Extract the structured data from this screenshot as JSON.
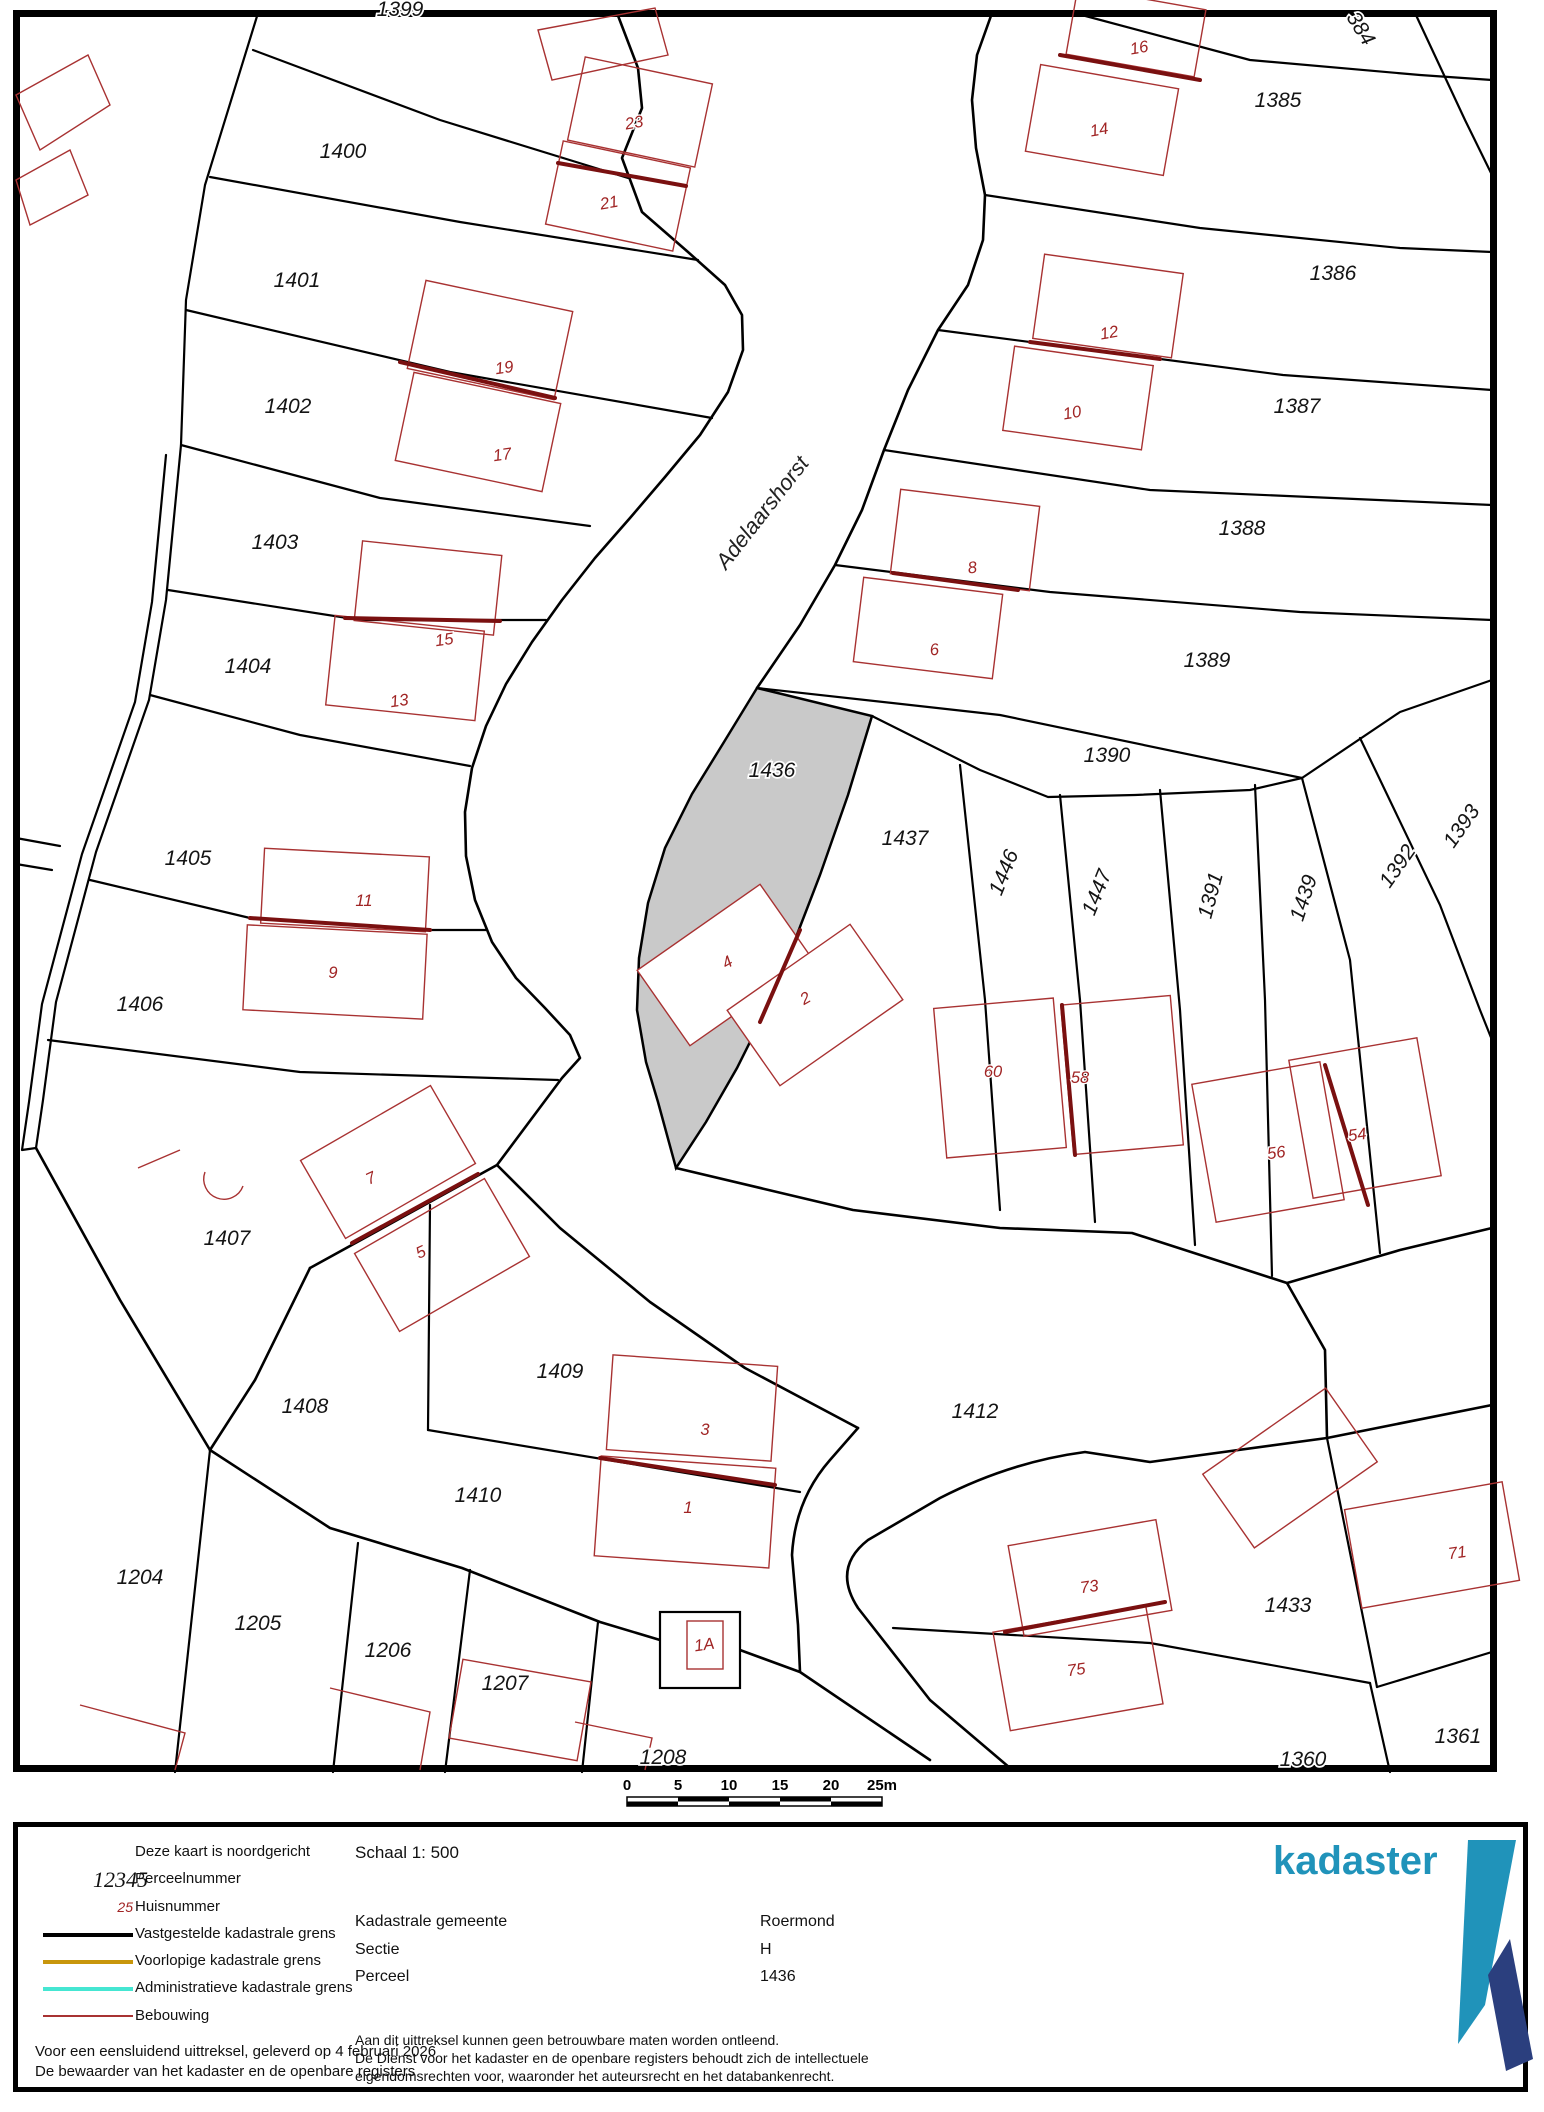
{
  "map": {
    "street_name": "Adelaarshorst",
    "highlight_parcel_fill": "#c9c9c9",
    "building_color": "#a83232",
    "scale_ticks": [
      "0",
      "5",
      "10",
      "15",
      "20",
      "25m"
    ],
    "labels": [
      {
        "text": "1399",
        "x": 400,
        "y": 16,
        "rot": 0,
        "type": "parcel"
      },
      {
        "text": "1400",
        "x": 343,
        "y": 158,
        "rot": 0,
        "type": "parcel"
      },
      {
        "text": "1401",
        "x": 297,
        "y": 287,
        "rot": 0,
        "type": "parcel"
      },
      {
        "text": "1402",
        "x": 288,
        "y": 413,
        "rot": 0,
        "type": "parcel"
      },
      {
        "text": "1403",
        "x": 275,
        "y": 549,
        "rot": 0,
        "type": "parcel"
      },
      {
        "text": "1404",
        "x": 248,
        "y": 673,
        "rot": 0,
        "type": "parcel"
      },
      {
        "text": "1405",
        "x": 188,
        "y": 865,
        "rot": 0,
        "type": "parcel"
      },
      {
        "text": "1406",
        "x": 140,
        "y": 1011,
        "rot": 0,
        "type": "parcel"
      },
      {
        "text": "1407",
        "x": 227,
        "y": 1245,
        "rot": 0,
        "type": "parcel"
      },
      {
        "text": "1408",
        "x": 305,
        "y": 1413,
        "rot": 0,
        "type": "parcel"
      },
      {
        "text": "1409",
        "x": 560,
        "y": 1378,
        "rot": 0,
        "type": "parcel"
      },
      {
        "text": "1410",
        "x": 478,
        "y": 1502,
        "rot": 0,
        "type": "parcel"
      },
      {
        "text": "1412",
        "x": 975,
        "y": 1418,
        "rot": 0,
        "type": "parcel"
      },
      {
        "text": "1204",
        "x": 140,
        "y": 1584,
        "rot": 0,
        "type": "parcel"
      },
      {
        "text": "1205",
        "x": 258,
        "y": 1630,
        "rot": 0,
        "type": "parcel"
      },
      {
        "text": "1206",
        "x": 388,
        "y": 1657,
        "rot": 0,
        "type": "parcel"
      },
      {
        "text": "1207",
        "x": 505,
        "y": 1690,
        "rot": 0,
        "type": "parcel"
      },
      {
        "text": "1208",
        "x": 663,
        "y": 1764,
        "rot": 0,
        "type": "parcel"
      },
      {
        "text": "384",
        "x": 1355,
        "y": 32,
        "rot": 58,
        "type": "parcel"
      },
      {
        "text": "1385",
        "x": 1278,
        "y": 107,
        "rot": 0,
        "type": "parcel"
      },
      {
        "text": "1386",
        "x": 1333,
        "y": 280,
        "rot": 0,
        "type": "parcel"
      },
      {
        "text": "1387",
        "x": 1297,
        "y": 413,
        "rot": 0,
        "type": "parcel"
      },
      {
        "text": "1388",
        "x": 1242,
        "y": 535,
        "rot": 0,
        "type": "parcel"
      },
      {
        "text": "1389",
        "x": 1207,
        "y": 667,
        "rot": 0,
        "type": "parcel"
      },
      {
        "text": "1390",
        "x": 1107,
        "y": 762,
        "rot": 0,
        "type": "parcel"
      },
      {
        "text": "1436",
        "x": 772,
        "y": 777,
        "rot": 0,
        "type": "parcel"
      },
      {
        "text": "1437",
        "x": 905,
        "y": 845,
        "rot": 0,
        "type": "parcel"
      },
      {
        "text": "1446",
        "x": 1010,
        "y": 875,
        "rot": -68,
        "type": "parcel"
      },
      {
        "text": "1447",
        "x": 1103,
        "y": 895,
        "rot": -68,
        "type": "parcel"
      },
      {
        "text": "1391",
        "x": 1217,
        "y": 897,
        "rot": -75,
        "type": "parcel"
      },
      {
        "text": "1439",
        "x": 1310,
        "y": 900,
        "rot": -72,
        "type": "parcel"
      },
      {
        "text": "1392",
        "x": 1403,
        "y": 870,
        "rot": -55,
        "type": "parcel"
      },
      {
        "text": "1393",
        "x": 1467,
        "y": 830,
        "rot": -55,
        "type": "parcel"
      },
      {
        "text": "1433",
        "x": 1288,
        "y": 1612,
        "rot": 0,
        "type": "parcel"
      },
      {
        "text": "1361",
        "x": 1458,
        "y": 1743,
        "rot": 0,
        "type": "parcel"
      },
      {
        "text": "1360",
        "x": 1303,
        "y": 1766,
        "rot": 0,
        "type": "parcel"
      },
      {
        "text": "Adelaarshorst",
        "x": 768,
        "y": 517,
        "rot": -52,
        "type": "street"
      },
      {
        "text": "23",
        "x": 635,
        "y": 128,
        "rot": -10,
        "type": "house"
      },
      {
        "text": "21",
        "x": 610,
        "y": 208,
        "rot": -10,
        "type": "house"
      },
      {
        "text": "19",
        "x": 505,
        "y": 373,
        "rot": -8,
        "type": "house"
      },
      {
        "text": "17",
        "x": 503,
        "y": 460,
        "rot": -8,
        "type": "house"
      },
      {
        "text": "15",
        "x": 445,
        "y": 645,
        "rot": -8,
        "type": "house"
      },
      {
        "text": "13",
        "x": 400,
        "y": 706,
        "rot": -8,
        "type": "house"
      },
      {
        "text": "11",
        "x": 364,
        "y": 906,
        "rot": 0,
        "type": "house"
      },
      {
        "text": "9",
        "x": 333,
        "y": 978,
        "rot": 0,
        "type": "house"
      },
      {
        "text": "7",
        "x": 373,
        "y": 1183,
        "rot": -25,
        "type": "house"
      },
      {
        "text": "5",
        "x": 423,
        "y": 1257,
        "rot": -25,
        "type": "house"
      },
      {
        "text": "3",
        "x": 705,
        "y": 1435,
        "rot": 0,
        "type": "house"
      },
      {
        "text": "1",
        "x": 688,
        "y": 1513,
        "rot": 0,
        "type": "house"
      },
      {
        "text": "1A",
        "x": 705,
        "y": 1650,
        "rot": -8,
        "type": "house"
      },
      {
        "text": "16",
        "x": 1140,
        "y": 53,
        "rot": -10,
        "type": "house"
      },
      {
        "text": "14",
        "x": 1100,
        "y": 135,
        "rot": -10,
        "type": "house"
      },
      {
        "text": "12",
        "x": 1110,
        "y": 338,
        "rot": -10,
        "type": "house"
      },
      {
        "text": "10",
        "x": 1073,
        "y": 418,
        "rot": -10,
        "type": "house"
      },
      {
        "text": "8",
        "x": 973,
        "y": 573,
        "rot": -8,
        "type": "house"
      },
      {
        "text": "6",
        "x": 935,
        "y": 655,
        "rot": -8,
        "type": "house"
      },
      {
        "text": "4",
        "x": 730,
        "y": 967,
        "rot": -30,
        "type": "house"
      },
      {
        "text": "2",
        "x": 808,
        "y": 1003,
        "rot": -30,
        "type": "house"
      },
      {
        "text": "60",
        "x": 993,
        "y": 1077,
        "rot": 0,
        "type": "house"
      },
      {
        "text": "58",
        "x": 1080,
        "y": 1083,
        "rot": 0,
        "type": "house"
      },
      {
        "text": "56",
        "x": 1277,
        "y": 1158,
        "rot": -8,
        "type": "house"
      },
      {
        "text": "54",
        "x": 1358,
        "y": 1140,
        "rot": -8,
        "type": "house"
      },
      {
        "text": "73",
        "x": 1090,
        "y": 1592,
        "rot": -8,
        "type": "house"
      },
      {
        "text": "75",
        "x": 1077,
        "y": 1675,
        "rot": -8,
        "type": "house"
      },
      {
        "text": "71",
        "x": 1458,
        "y": 1558,
        "rot": -8,
        "type": "house"
      }
    ]
  },
  "footer": {
    "legend": {
      "sample_parcel": "12345",
      "sample_house": "25",
      "items": [
        "Deze kaart is noordgericht",
        "Perceelnummer",
        "Huisnummer",
        "Vastgestelde kadastrale grens",
        "Voorlopige kadastrale grens",
        "Administratieve kadastrale grens",
        "Bebouwing"
      ],
      "line_colors": {
        "vastgesteld": "#000000",
        "voorlopig": "#c8960c",
        "administratief": "#45e6d2",
        "bebouwing": "#a83232"
      }
    },
    "schaal": "Schaal 1: 500",
    "fields": [
      {
        "label": "Kadastrale gemeente",
        "value": "Roermond"
      },
      {
        "label": "Sectie",
        "value": "H"
      },
      {
        "label": "Perceel",
        "value": "1436"
      }
    ],
    "delivery_lines": [
      "Voor een eensluidend uittreksel, geleverd op 4 februari 2026",
      "De bewaarder van het kadaster en de openbare registers"
    ],
    "disclaimer_lines": [
      "Aan dit uittreksel kunnen geen betrouwbare maten worden ontleend.",
      "De Dienst voor het kadaster en de openbare registers behoudt zich de intellectuele",
      "eigendomsrechten voor, waaronder het auteursrecht en het databankenrecht."
    ],
    "logo_text": "kadaster",
    "logo_colors": {
      "light": "#2093ba",
      "dark": "#2b3f7e"
    }
  }
}
